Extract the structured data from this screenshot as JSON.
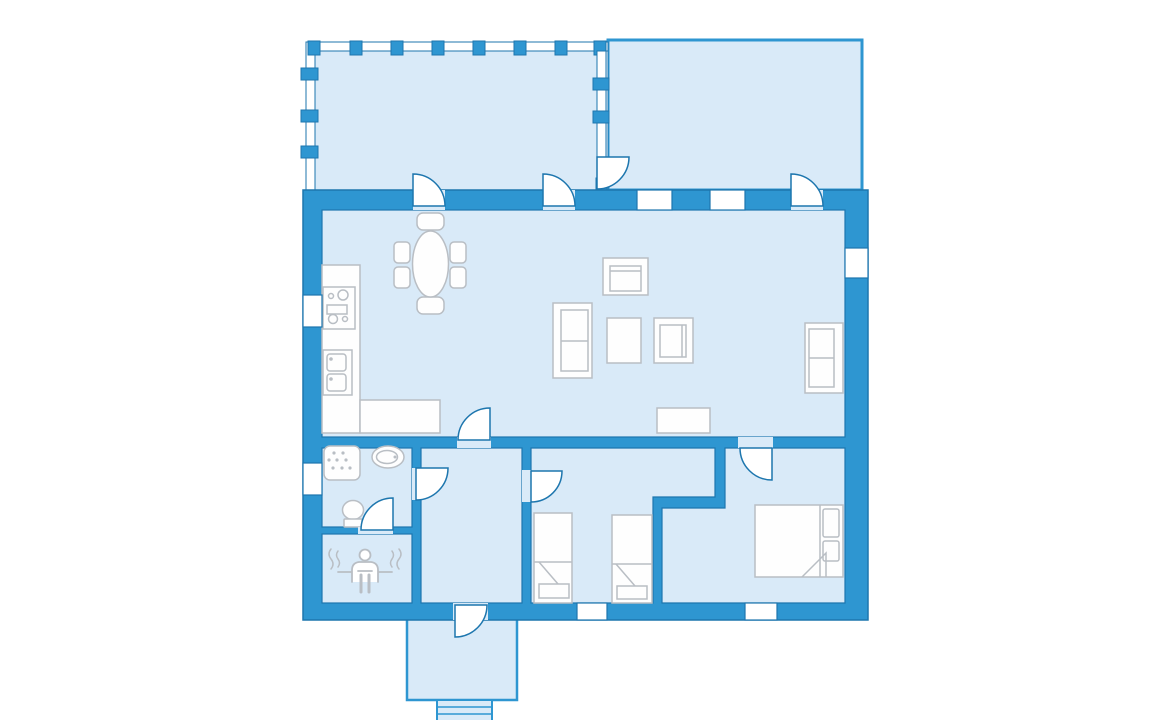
{
  "title": "Cottage floor plan",
  "colors": {
    "wall": "#2E96D1",
    "wall_outline": "#1D76AE",
    "floor": "#D9EAF8",
    "furniture_outline": "#B9BEC4",
    "fixture_fill": "#FEFEFE",
    "background": "#FFFFFF"
  },
  "rooms": [
    {
      "id": "covered-porch",
      "description": "open porch with railing and pillars, top left"
    },
    {
      "id": "terrace",
      "description": "open terrace, top right"
    },
    {
      "id": "living-kitchen",
      "description": "combined kitchen / dining / living room",
      "furniture": [
        "kitchen counter",
        "stove with burners",
        "double sink",
        "oval dining table",
        "6 dining chairs",
        "two-seat sofa",
        "armchair",
        "armchair",
        "coffee table",
        "wall sofa",
        "sideboard"
      ]
    },
    {
      "id": "bathroom",
      "fixtures": [
        "shower",
        "washbasin",
        "toilet"
      ]
    },
    {
      "id": "sauna",
      "fixtures": [
        "sauna bench with bather pictogram"
      ]
    },
    {
      "id": "hallway",
      "fixtures": []
    },
    {
      "id": "bedroom-middle",
      "furniture": [
        "single bed",
        "single bed"
      ]
    },
    {
      "id": "bedroom-right",
      "furniture": [
        "double bed with two pillows"
      ]
    },
    {
      "id": "entrance-porch",
      "features": [
        "front steps"
      ]
    }
  ],
  "counts": {
    "doors": 10,
    "windows": 7,
    "porch_posts": 13,
    "beds": 3
  },
  "doors": [
    "living-to-porch-left",
    "living-to-porch-right",
    "living-to-terrace",
    "porch-to-terrace-divider",
    "living-to-hallway",
    "bathroom-to-hallway",
    "bathroom-to-sauna",
    "hallway-to-middle-bedroom",
    "right-bedroom",
    "front-entrance"
  ],
  "windows": [
    "kitchen-west",
    "bathroom-west",
    "terrace-wall-1",
    "terrace-wall-2",
    "living-east",
    "middle-bedroom-south",
    "right-bedroom-south"
  ]
}
